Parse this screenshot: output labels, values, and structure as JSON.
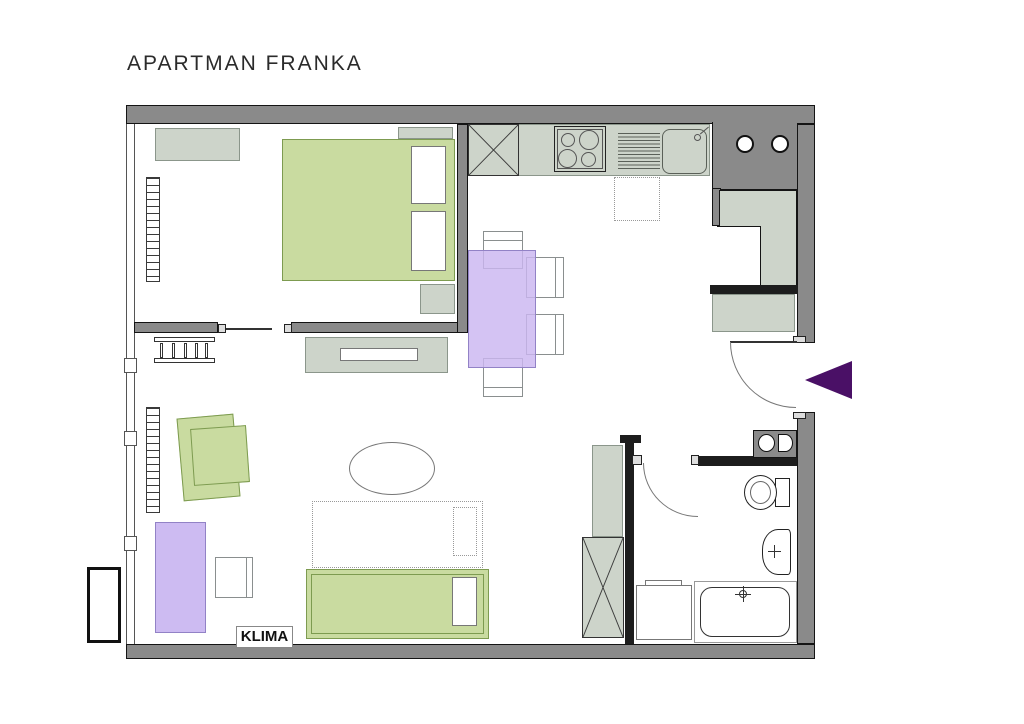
{
  "title": "APARTMAN FRANKA",
  "labels": {
    "klima": "KLIMA"
  },
  "colors": {
    "wall": "#8a8a8a",
    "wallDark": "#1d1d1d",
    "furn": "#cdd4ca",
    "furnBorder": "#8b968b",
    "green": "#c9dba0",
    "greenBorder": "#7d9b50",
    "purple": "#cdbbf2",
    "purpleA": "rgba(202,182,240,0.82)",
    "purpleBorder": "#9282c6",
    "arrow": "#4a1066",
    "text": "#2b2b2b"
  }
}
